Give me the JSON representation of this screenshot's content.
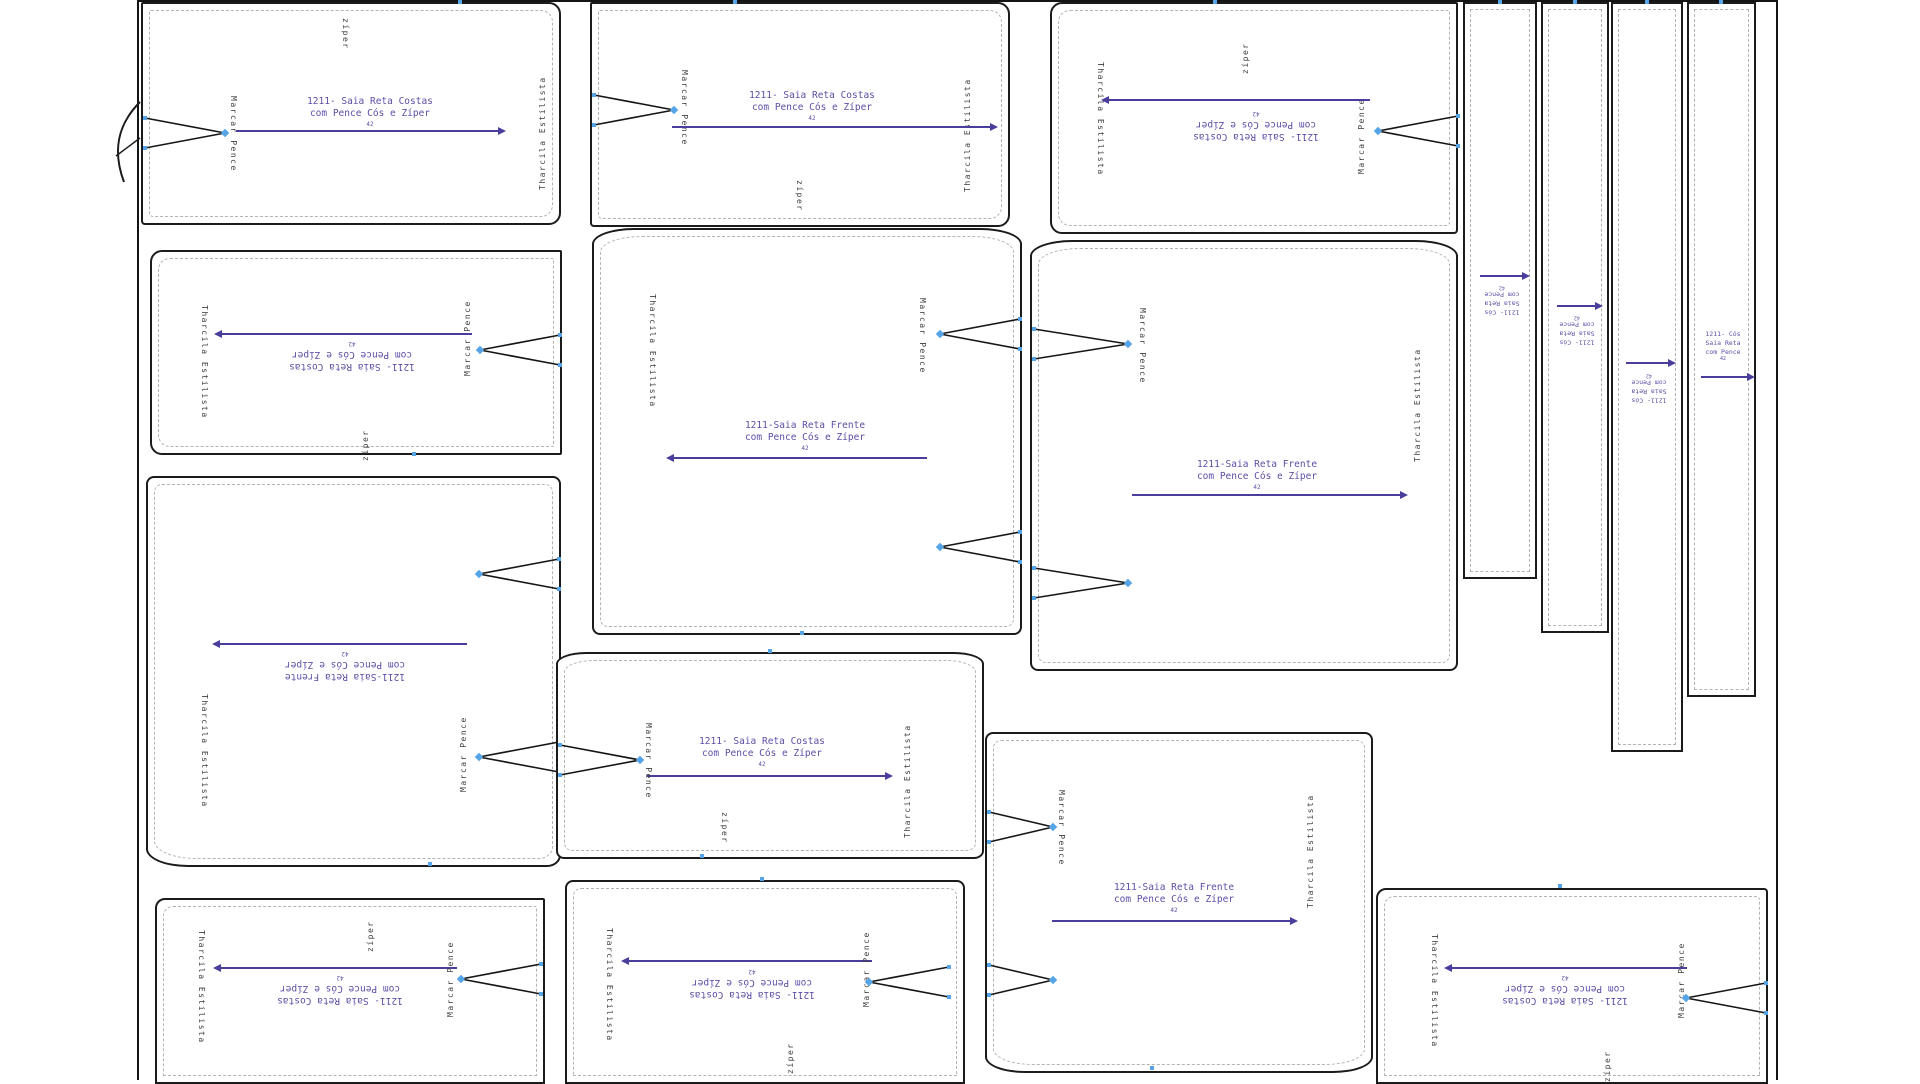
{
  "labels": {
    "designer": "Tharcila Estilista",
    "pence": "Marcar Pence",
    "zipper": "zíper",
    "back": "1211- Saia  Reta Costas\ncom Pence Cós e Zíper",
    "front": "1211-Saia Reta Frente\ncom Pence Cós e Zíper",
    "waistband": "1211- Cós\nSaia Reta\ncom Pence",
    "size": "42"
  },
  "colors": {
    "outline": "#1b1b1b",
    "seam_dash": "#b3b3b3",
    "label_text": "#5b4fa6",
    "arrow": "#4a3e9c",
    "notch": "#55a4e8",
    "side_text": "#3c3c3c",
    "background": "#ffffff"
  }
}
